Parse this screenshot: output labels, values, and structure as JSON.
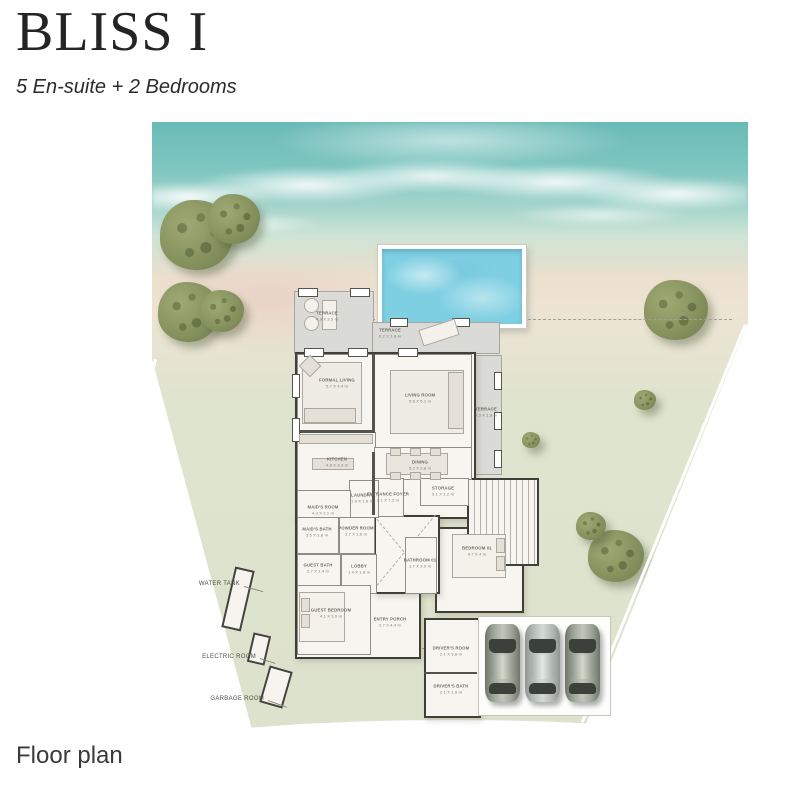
{
  "header": {
    "title": "BLISS I",
    "subtitle": "5 En-suite + 2 Bedrooms"
  },
  "footer": {
    "caption": "Floor plan"
  },
  "site_labels": {
    "water_tank": "WATER TANK",
    "electric_room": "ELECTRIC ROOM",
    "garbage_room": "GARBAGE ROOM"
  },
  "rooms": {
    "terrace_lounge": {
      "name": "TERRACE",
      "dims": "4.9 X 3.5 m"
    },
    "terrace_top": {
      "name": "TERRACE",
      "dims": "6.2 X 1.8 m"
    },
    "formal_living": {
      "name": "FORMAL LIVING",
      "dims": "5.7 X 4.4 m"
    },
    "living_room": {
      "name": "LIVING ROOM",
      "dims": "5.6 X 5.1 m"
    },
    "terrace_right": {
      "name": "TERRACE",
      "dims": "3.3 X 1.8 m"
    },
    "kitchen": {
      "name": "KITCHEN",
      "dims": "4.8 X 3.3 m"
    },
    "dining": {
      "name": "DINING",
      "dims": "5.2 X 3.8 m"
    },
    "entrance_foyer": {
      "name": "ENTRANCE FOYER",
      "dims": "2.1 X 7.2 m"
    },
    "laundry": {
      "name": "LAUNDRY",
      "dims": "1.9 X 1.6 m"
    },
    "maids_room": {
      "name": "MAID'S ROOM",
      "dims": "4.3 X 2.1 m"
    },
    "storage": {
      "name": "STORAGE",
      "dims": "3.1 X 1.2 m"
    },
    "maids_bath": {
      "name": "MAID'S BATH",
      "dims": "3.5 X 1.8 m"
    },
    "powder_room": {
      "name": "POWDER ROOM",
      "dims": "1.7 X 1.6 m"
    },
    "guest_bath": {
      "name": "GUEST BATH",
      "dims": "2.7 X 1.4 m"
    },
    "lobby": {
      "name": "LOBBY",
      "dims": "1.4 X 1.8 m"
    },
    "bathroom_01": {
      "name": "BATHROOM 01",
      "dims": "1.7 X 3.9 m"
    },
    "bedroom_01": {
      "name": "BEDROOM 01",
      "dims": "4.7 X 4 m"
    },
    "guest_bedroom": {
      "name": "GUEST BEDROOM",
      "dims": "4.1 X 3.9 m"
    },
    "entry_porch": {
      "name": "ENTRY PORCH",
      "dims": "2.7 X 4.4 m"
    },
    "drivers_room": {
      "name": "DRIVER'S ROOM",
      "dims": "2.1 X 3.8 m"
    },
    "drivers_bath": {
      "name": "DRIVER'S BATH",
      "dims": "2.1 X 1.8 m"
    }
  },
  "colors": {
    "sea": "#69bab6",
    "sand": "#e9dbc8",
    "lawn": "#dfe4cf",
    "pool": "#7ecfe2",
    "terrace": "#dadad6",
    "room_fill": "#f7f5ef",
    "wall": "#3f3e39",
    "tree": "#87935f"
  }
}
